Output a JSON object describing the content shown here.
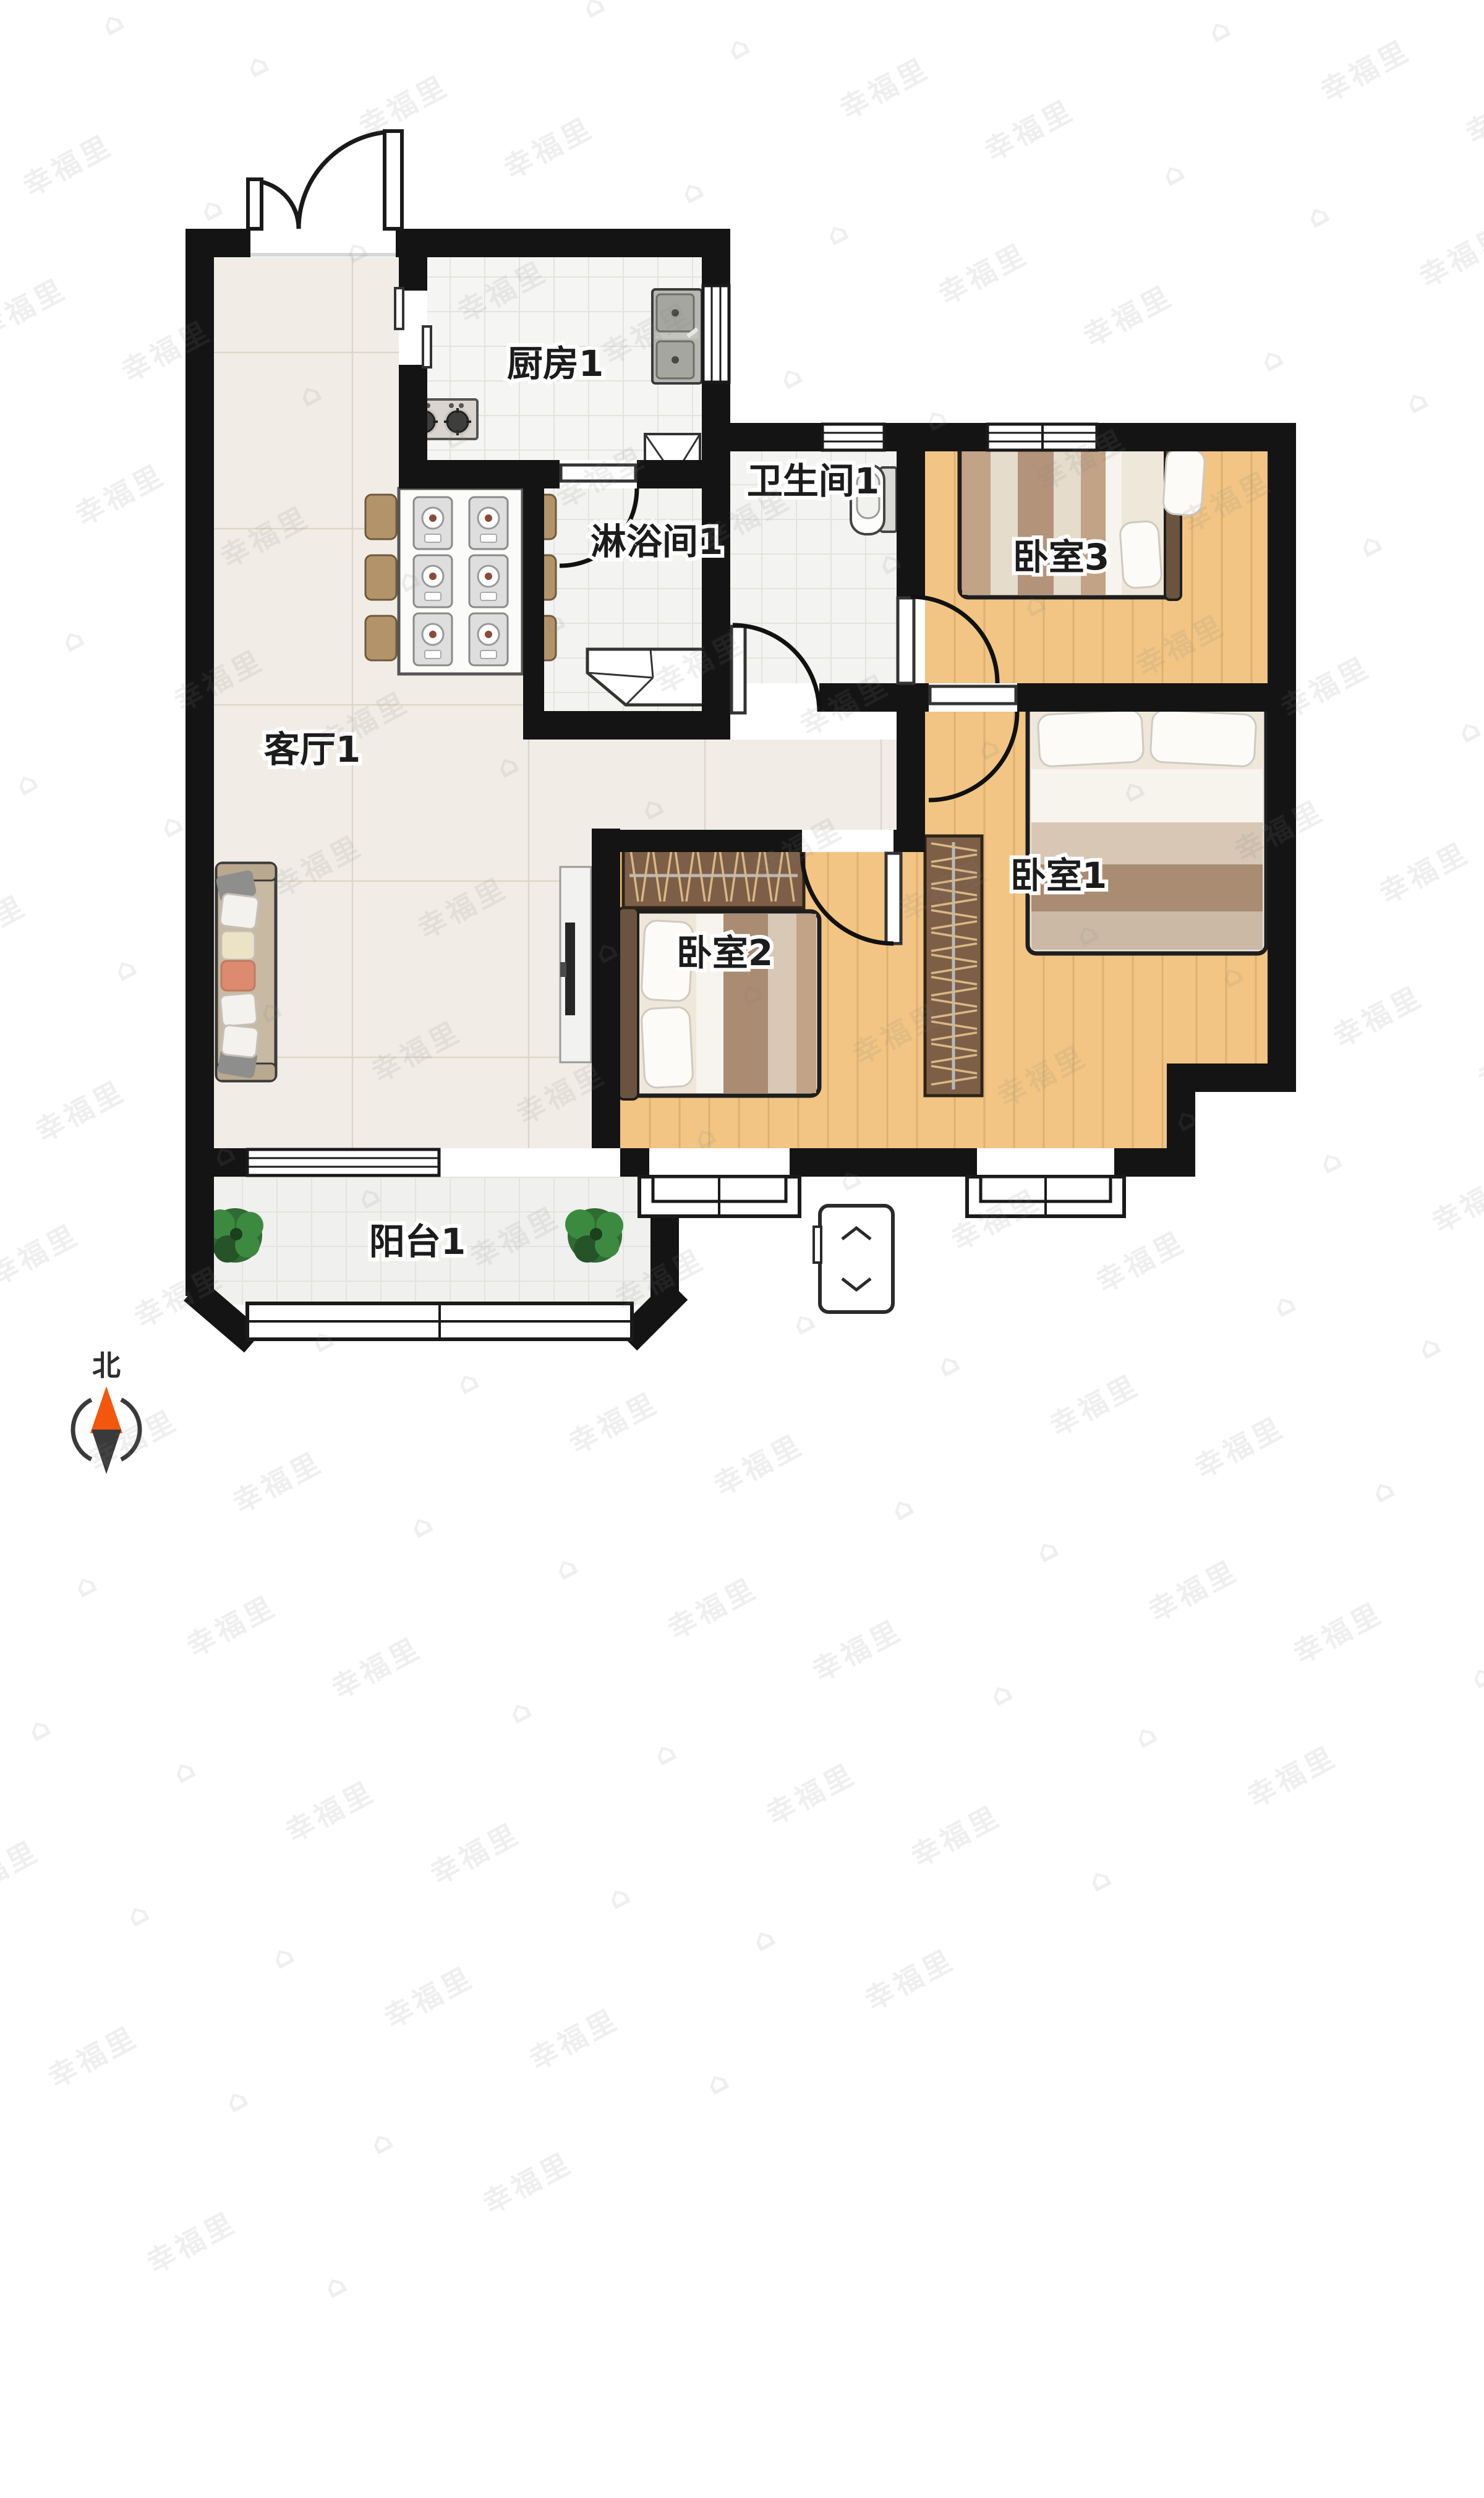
{
  "rooms": {
    "kitchen": {
      "label": "厨房1"
    },
    "bathroom": {
      "label": "卫生间1"
    },
    "shower": {
      "label": "淋浴间1"
    },
    "bedroom3": {
      "label": "卧室3"
    },
    "living": {
      "label": "客厅1"
    },
    "bedroom2": {
      "label": "卧室2"
    },
    "bedroom1": {
      "label": "卧室1"
    },
    "balcony": {
      "label": "阳台1"
    }
  },
  "compass": {
    "north_label": "北"
  },
  "watermark": {
    "text": "幸福里",
    "house_glyph": "⌂"
  },
  "colors": {
    "wall": "#141414",
    "marble_floor": "#f1ede6",
    "tile_floor": "#f5f5f3",
    "wood_floor": "#f2c584",
    "wardrobe": "#7d5f48",
    "compass_north": "#f4560d",
    "compass_south": "#3a3a3a",
    "plant": "#2f6b33"
  }
}
